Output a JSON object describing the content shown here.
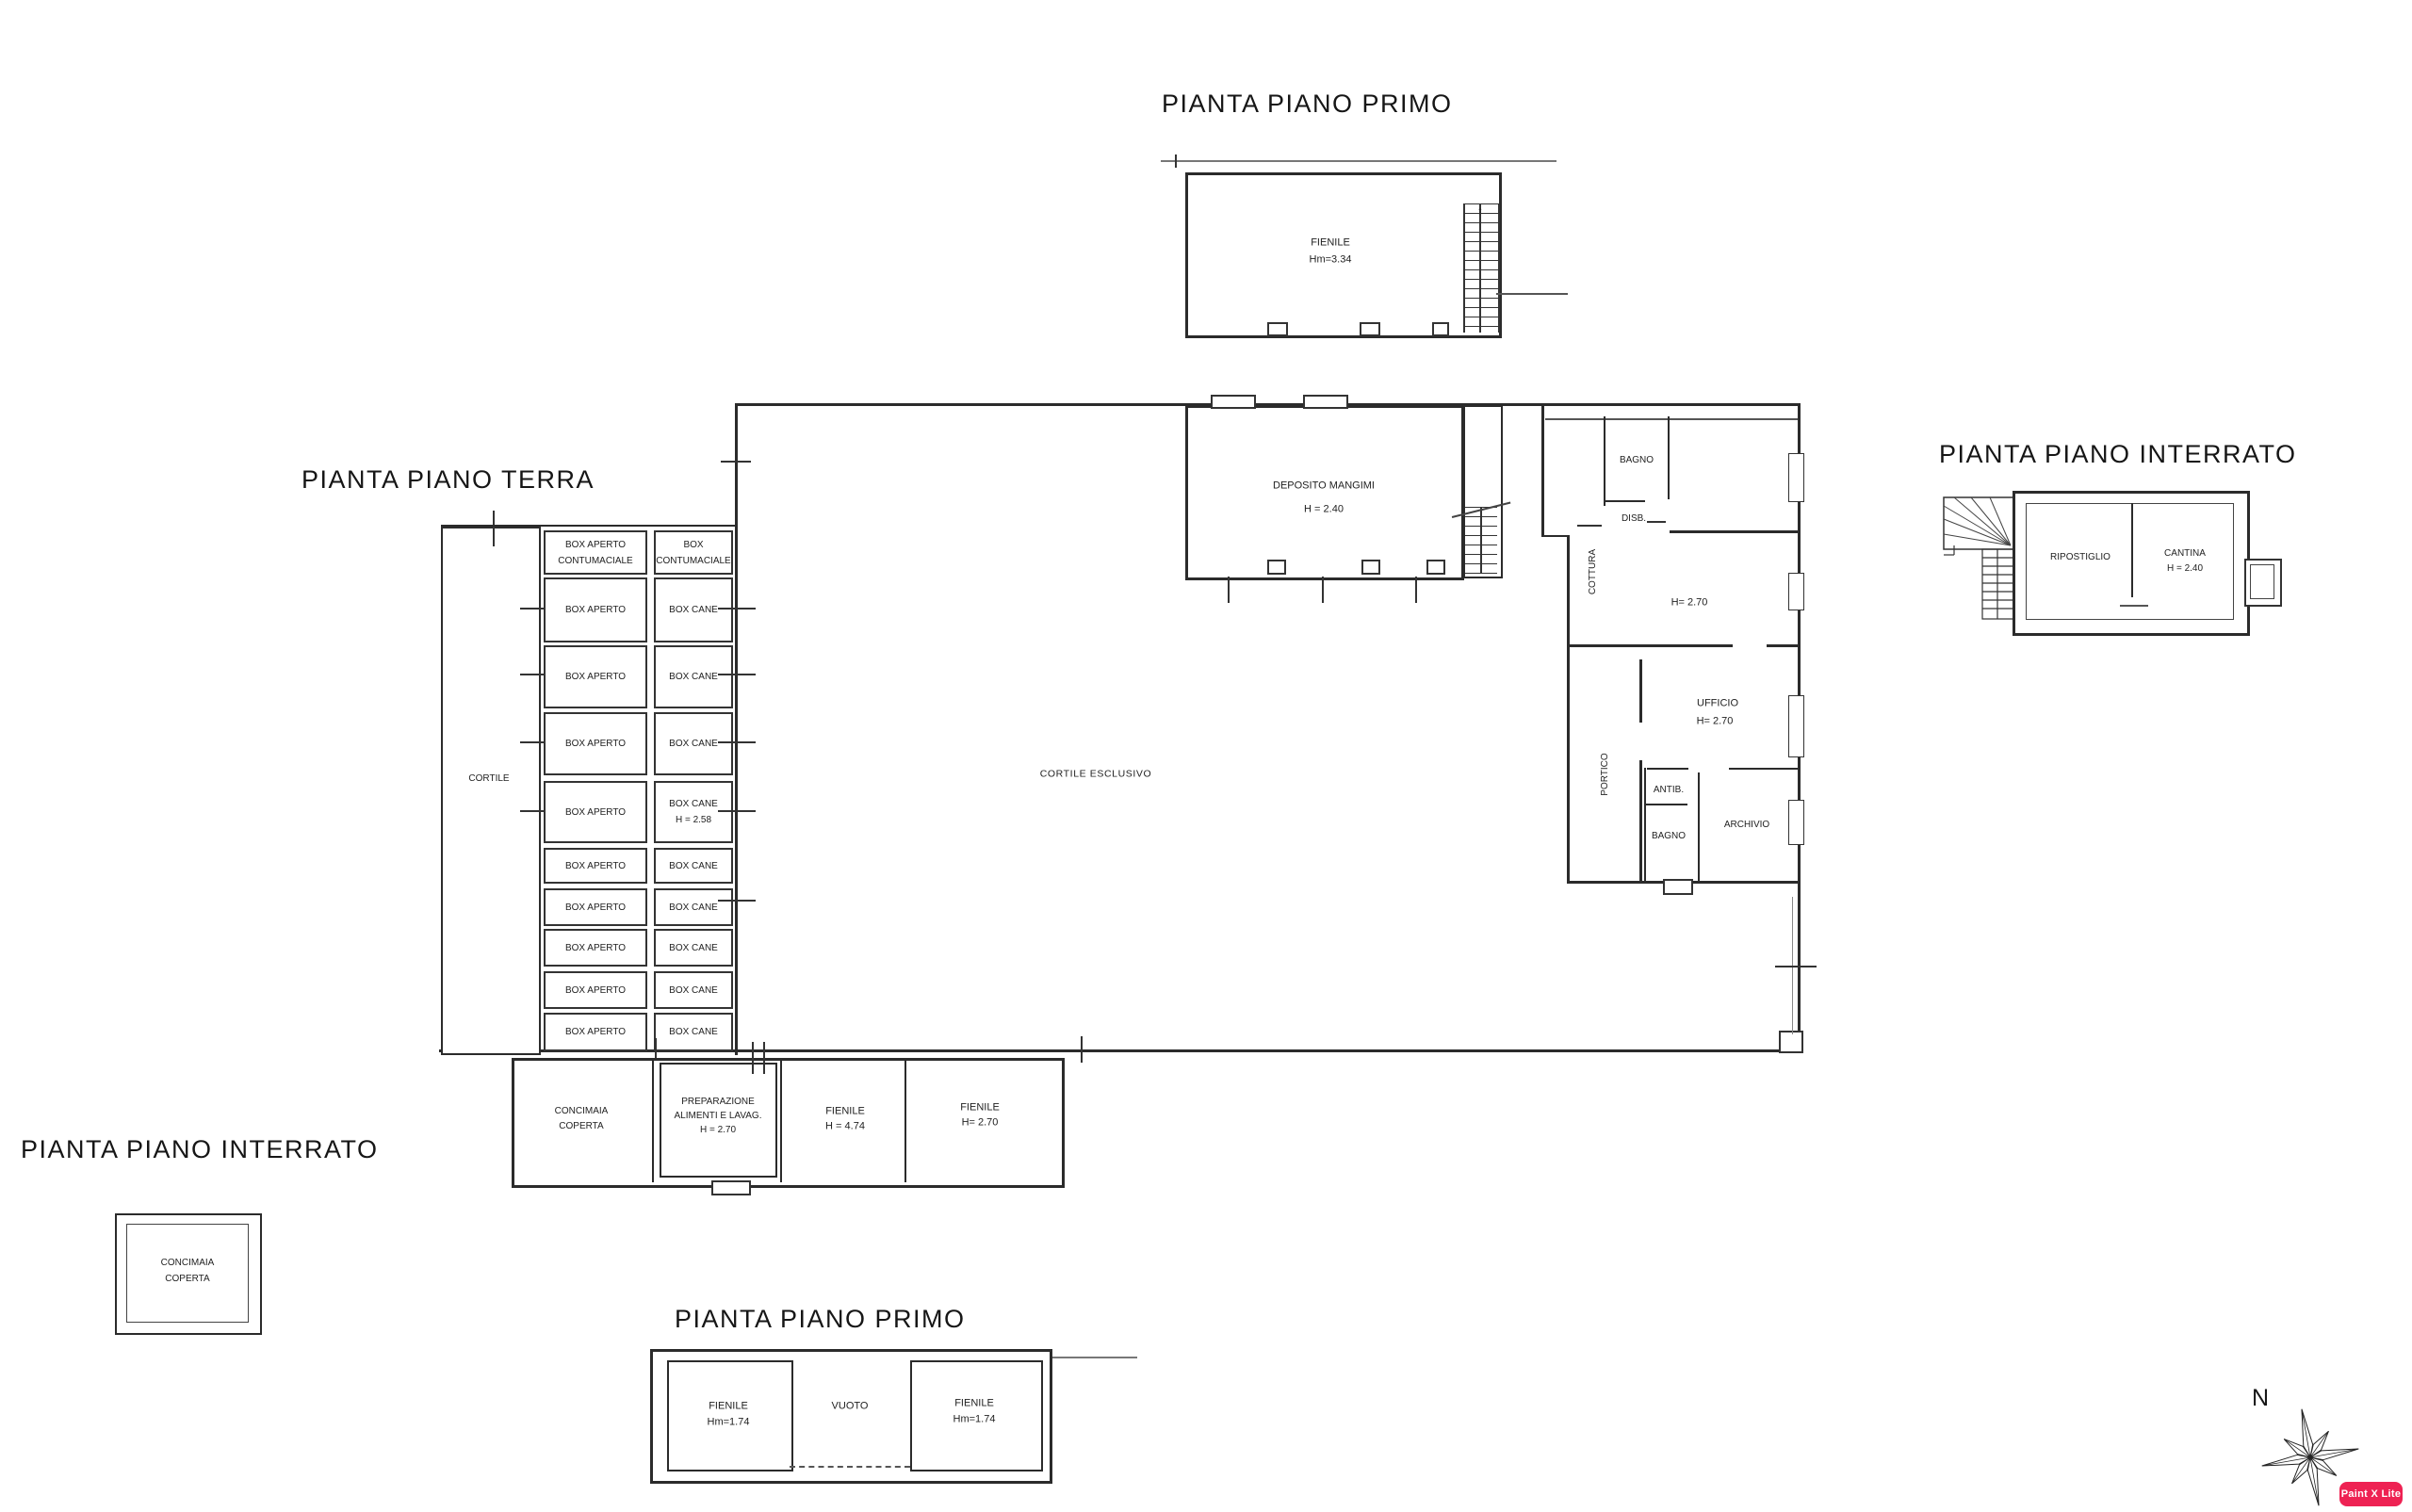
{
  "titles": {
    "top_primo": "PIANTA PIANO PRIMO",
    "terra": "PIANTA PIANO TERRA",
    "right_interrato": "PIANTA PIANO INTERRATO",
    "bottom_left_interrato": "PIANTA PIANO INTERRATO",
    "bottom_primo": "PIANTA PIANO PRIMO"
  },
  "plan_top_primo": {
    "fienile_name": "FIENILE",
    "fienile_height": "Hm=3.34"
  },
  "plan_terra": {
    "cortile": "CORTILE",
    "cortile_esclusivo": "CORTILE ESCLUSIVO",
    "deposito_name": "DEPOSITO MANGIMI",
    "deposito_height": "H = 2.40",
    "box_rows": [
      {
        "left1": "BOX APERTO",
        "left2": "CONTUMACIALE",
        "right1": "BOX",
        "right2": "CONTUMACIALE"
      },
      {
        "left1": "BOX APERTO",
        "right1": "BOX CANE"
      },
      {
        "left1": "BOX APERTO",
        "right1": "BOX CANE"
      },
      {
        "left1": "BOX APERTO",
        "right1": "BOX CANE"
      },
      {
        "left1": "BOX APERTO",
        "right1": "BOX CANE",
        "right2": "H = 2.58"
      },
      {
        "left1": "BOX APERTO",
        "right1": "BOX CANE"
      },
      {
        "left1": "BOX APERTO",
        "right1": "BOX CANE"
      },
      {
        "left1": "BOX APERTO",
        "right1": "BOX CANE"
      },
      {
        "left1": "BOX APERTO",
        "right1": "BOX CANE"
      },
      {
        "left1": "BOX APERTO",
        "right1": "BOX CANE"
      }
    ],
    "right_wing": {
      "bagno_top": "BAGNO",
      "disb": "DISB.",
      "cottura": "COTTURA",
      "kitchen_height": "H= 2.70",
      "portico": "PORTICO",
      "ufficio_name": "UFFICIO",
      "ufficio_height": "H= 2.70",
      "antib": "ANTIB.",
      "bagno_low": "BAGNO",
      "archivio": "ARCHIVIO"
    },
    "service_rooms": {
      "concimaia_line1": "CONCIMAIA",
      "concimaia_line2": "COPERTA",
      "prep_line1": "PREPARAZIONE",
      "prep_line2": "ALIMENTI E LAVAG.",
      "prep_line3": "H = 2.70",
      "fienile1_name": "FIENILE",
      "fienile1_height": "H = 4.74",
      "fienile2_name": "FIENILE",
      "fienile2_height": "H= 2.70"
    }
  },
  "plan_right_interrato": {
    "ripostiglio": "RIPOSTIGLIO",
    "cantina_name": "CANTINA",
    "cantina_height": "H = 2.40"
  },
  "plan_bottom_left_interrato": {
    "line1": "CONCIMAIA",
    "line2": "COPERTA"
  },
  "plan_bottom_primo": {
    "fienile_left_name": "FIENILE",
    "fienile_left_height": "Hm=1.74",
    "vuoto": "VUOTO",
    "fienile_right_name": "FIENILE",
    "fienile_right_height": "Hm=1.74"
  },
  "compass": {
    "north_label": "N"
  },
  "watermark": {
    "label": "Paint X Lite",
    "bg_color": "#ee2253",
    "text_color": "#ffffff"
  }
}
